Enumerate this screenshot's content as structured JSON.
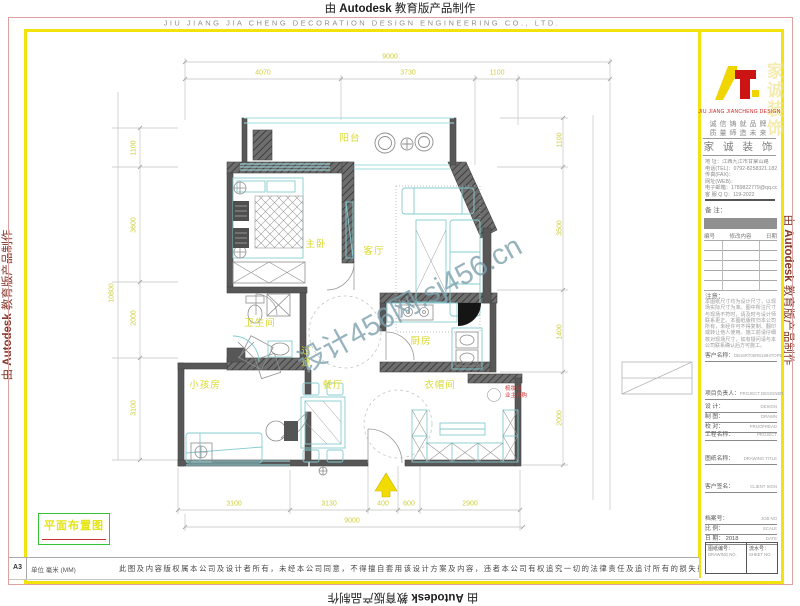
{
  "autodesk_mark": {
    "pre": "由",
    "brand": "Autodesk",
    "post": "教育版产品制作"
  },
  "header": {
    "company_en": "JIU JIANG JIA CHENG DECORATION DESIGN ENGINEERING CO., LTD."
  },
  "watermark": {
    "text": "设计456网.sj456.cn"
  },
  "plan": {
    "title": "平面布置图",
    "room_labels": [
      {
        "id": "balcony",
        "text": "阳台",
        "x": 350,
        "y": 137
      },
      {
        "id": "master-bedroom",
        "text": "主卧",
        "x": 316,
        "y": 243
      },
      {
        "id": "living-room",
        "text": "客厅",
        "x": 374,
        "y": 250
      },
      {
        "id": "bathroom",
        "text": "卫生间",
        "x": 260,
        "y": 322
      },
      {
        "id": "kitchen",
        "text": "厨房",
        "x": 421,
        "y": 340
      },
      {
        "id": "hallway",
        "text": "过道",
        "x": 304,
        "y": 357,
        "vertical": true
      },
      {
        "id": "kids-room",
        "text": "小孩房",
        "x": 205,
        "y": 384
      },
      {
        "id": "dining-room",
        "text": "餐厅",
        "x": 333,
        "y": 384
      },
      {
        "id": "cloakroom",
        "text": "衣帽间",
        "x": 440,
        "y": 384
      }
    ],
    "red_note": {
      "line1": "梳妆台",
      "line2": "业主自购",
      "x": 505,
      "y": 386
    },
    "dims": {
      "top_total": "9000",
      "top_segments": [
        "4070",
        "3730",
        "1100"
      ],
      "bottom_segments": [
        "3100",
        "3130",
        "400",
        "600",
        "2900"
      ],
      "bottom_total": "9000",
      "left_segments": [
        "1100",
        "3600",
        "2000",
        "3100"
      ],
      "left_total": "10800",
      "right_segments": [
        "1100",
        "3500",
        "1400",
        "2000"
      ]
    }
  },
  "title_block": {
    "brand_en": "JIU JIANG JIANCHENG DESIGN",
    "ghost_text": "家诚装饰",
    "slogans": [
      "诚信铸就品牌",
      "质量缔造未来"
    ],
    "banner": "家 诚 装 饰",
    "contact_lines": [
      "地 址：江西九江市甘棠山路",
      "电话(TEL)：0792-8258321 18270034710",
      "传真(FAX)：",
      "网址(WEB)：",
      "电子邮箱：1789822779@qq.com",
      "客 服 Q Q：119-2022"
    ],
    "note_label": "备 注：",
    "revision": {
      "headers": [
        "编号",
        "修改内容",
        "日期"
      ],
      "empty_rows": 5
    },
    "notice_title": "注意：",
    "notice_body": "本图纸尺寸均为设计尺寸，以现场实际尺寸为准。图中所注尺寸与现场不符时，请及时与设计师联系更正。本图纸版权归本公司所有，未经许可不得复制、翻印或转让他人使用。施工前请仔细核对现场尺寸，如有疑问请与本公司联系确认后方可施工。",
    "name_row": {
      "label": "客户名称：",
      "value": "DB16RT05RB1984TOPE"
    },
    "rows": [
      {
        "label": "项目负责人：",
        "en": "PROJECT DESIGNER"
      },
      {
        "label": "设  计：",
        "en": "DESIGN"
      },
      {
        "label": "制  图：",
        "en": "DRAWN"
      },
      {
        "label": "校  对：",
        "en": "PROOFREAD"
      },
      {
        "label": "工程名称：",
        "en": "PROJECT"
      },
      {
        "label": "图纸名称：",
        "en": "DRAWING TITLE"
      },
      {
        "label": "客户签名：",
        "en": "CLIENT SIGN"
      },
      {
        "label": "档案号：",
        "en": "JOB NO"
      },
      {
        "label": "比  例：",
        "en": "SCALE"
      },
      {
        "label": "日  期： 2018",
        "en": "DATE"
      }
    ],
    "sheet_no": {
      "label": "图纸编号：",
      "en": "DRAWING NO."
    },
    "serial_no": {
      "label": "流水号：",
      "en": "SHEET NO."
    }
  },
  "footer": {
    "sheet": "A3",
    "units": "单位 毫米 (MM)",
    "disclaimer": "此图及内容版权属本公司及设计者所有，未经本公司同意，不得擅自套用该设计方案及内容，违者本公司有权追究一切的法律责任及追讨所有的损失费用。"
  }
}
